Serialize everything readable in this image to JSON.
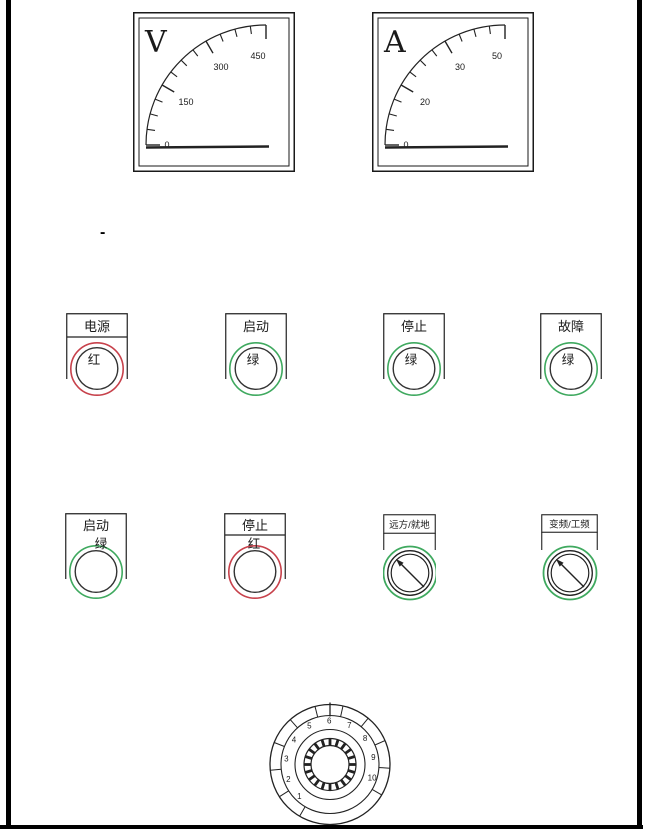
{
  "colors": {
    "line": "#222222",
    "red": "#c7414b",
    "green": "#3fa95f"
  },
  "meters": {
    "voltmeter": {
      "unit": "V",
      "ticks": [
        "0",
        "150",
        "300",
        "450"
      ]
    },
    "ammeter": {
      "unit": "A",
      "ticks": [
        "0",
        "20",
        "30",
        "50"
      ]
    }
  },
  "indicators": {
    "power": {
      "label": "电源",
      "lamp": "红"
    },
    "start": {
      "label": "启动",
      "lamp": "绿"
    },
    "stop": {
      "label": "停止",
      "lamp": "绿"
    },
    "fault": {
      "label": "故障",
      "lamp": "绿"
    }
  },
  "buttons": {
    "start": {
      "label": "启动",
      "color_text": "绿"
    },
    "stop": {
      "label": "停止",
      "color_text": "红"
    }
  },
  "selectors": {
    "remote_local": {
      "label": "远方/就地"
    },
    "vfd_mains": {
      "label": "变频/工频"
    }
  },
  "rotary": {
    "positions": [
      "1",
      "2",
      "3",
      "4",
      "5",
      "6",
      "7",
      "8",
      "9",
      "10"
    ]
  },
  "misc": {
    "dash": "-"
  }
}
